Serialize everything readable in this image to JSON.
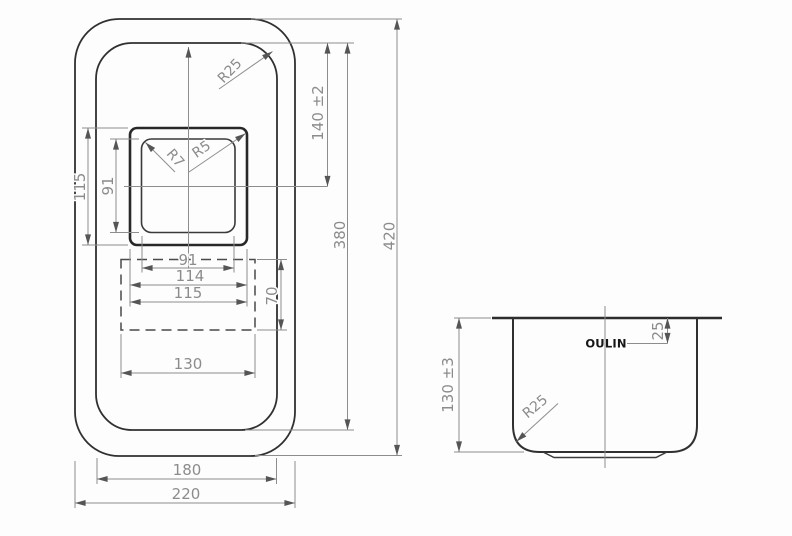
{
  "drawing_title": "sink-technical-drawing",
  "brand": {
    "logo": "OULIN"
  },
  "plan_view": {
    "dim_labels": {
      "bowl_opening_height": "115",
      "bowl_bottom_height": "91",
      "bowl_bottom_width": "91",
      "bowl_mid_width": "114",
      "bowl_opening_width": "115",
      "drain_recess_height": "70",
      "drain_recess_width": "130",
      "rim_width": "180",
      "overall_width": "220",
      "top_to_bowl_center": "140 ±2",
      "rim_length": "380",
      "overall_length": "420",
      "rim_corner_radius": "R25",
      "bowl_inner_corner_radius": "R7",
      "bowl_opening_corner_radius": "R5"
    }
  },
  "side_view": {
    "dim_labels": {
      "bowl_depth": "130 ±3",
      "logo_offset_from_rim": "25",
      "bowl_bottom_radius": "R25"
    }
  }
}
